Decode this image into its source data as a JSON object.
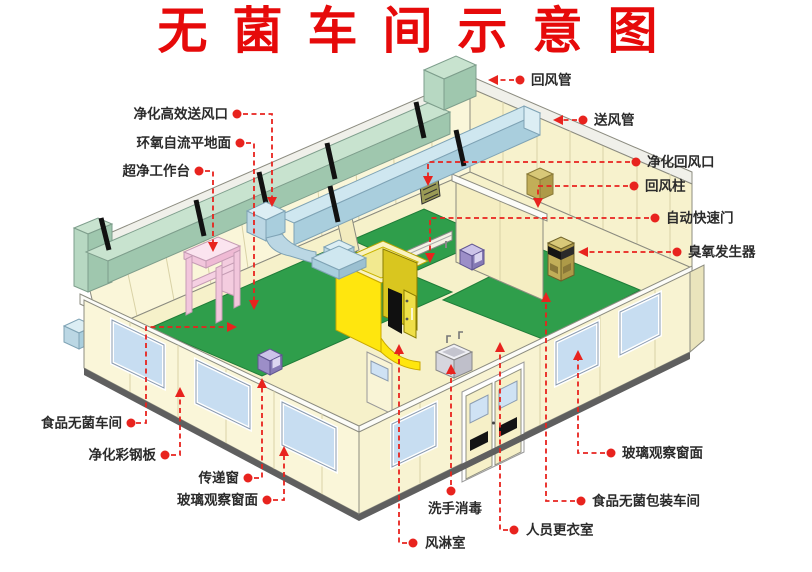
{
  "title": {
    "text": "无菌车间示意图",
    "color": "#e60a0a"
  },
  "labels": {
    "hepa_supply_outlet": {
      "text": "净化高效送风口"
    },
    "epoxy_floor": {
      "text": "环氧自流平地面"
    },
    "clean_bench": {
      "text": "超净工作台"
    },
    "food_sterile_workshop": {
      "text": "食品无菌车间"
    },
    "clean_steel_panel": {
      "text": "净化彩钢板"
    },
    "transfer_window": {
      "text": "传递窗"
    },
    "glass_window_left": {
      "text": "玻璃观察窗面"
    },
    "air_shower": {
      "text": "风淋室"
    },
    "hand_wash": {
      "text": "洗手消毒"
    },
    "changing_room": {
      "text": "人员更衣室"
    },
    "return_duct": {
      "text": "回风管"
    },
    "supply_duct": {
      "text": "送风管"
    },
    "purify_return_vent": {
      "text": "净化回风口"
    },
    "return_column": {
      "text": "回风柱"
    },
    "auto_fast_door": {
      "text": "自动快速门"
    },
    "ozone_generator": {
      "text": "臭氧发生器"
    },
    "glass_window_right": {
      "text": "玻璃观察窗面"
    },
    "food_packaging_workshop": {
      "text": "食品无菌包装车间"
    }
  },
  "colors": {
    "title_red": "#e60a0a",
    "leader_red": "#e8231e",
    "wall_cream": "#faf6d9",
    "floor_cream": "#f6f1ca",
    "floor_green": "#2f9e4b",
    "return_duct_green": "#c8e3cf",
    "supply_duct_blue": "#cfe7f0",
    "air_shower_yellow": "#ffe60e",
    "workbench_pink": "#fbe4ef",
    "equipment_purple": "#9c8ec8",
    "cabinet_tan": "#c2ae58",
    "window_glass_blue": "#c7ddf1"
  }
}
